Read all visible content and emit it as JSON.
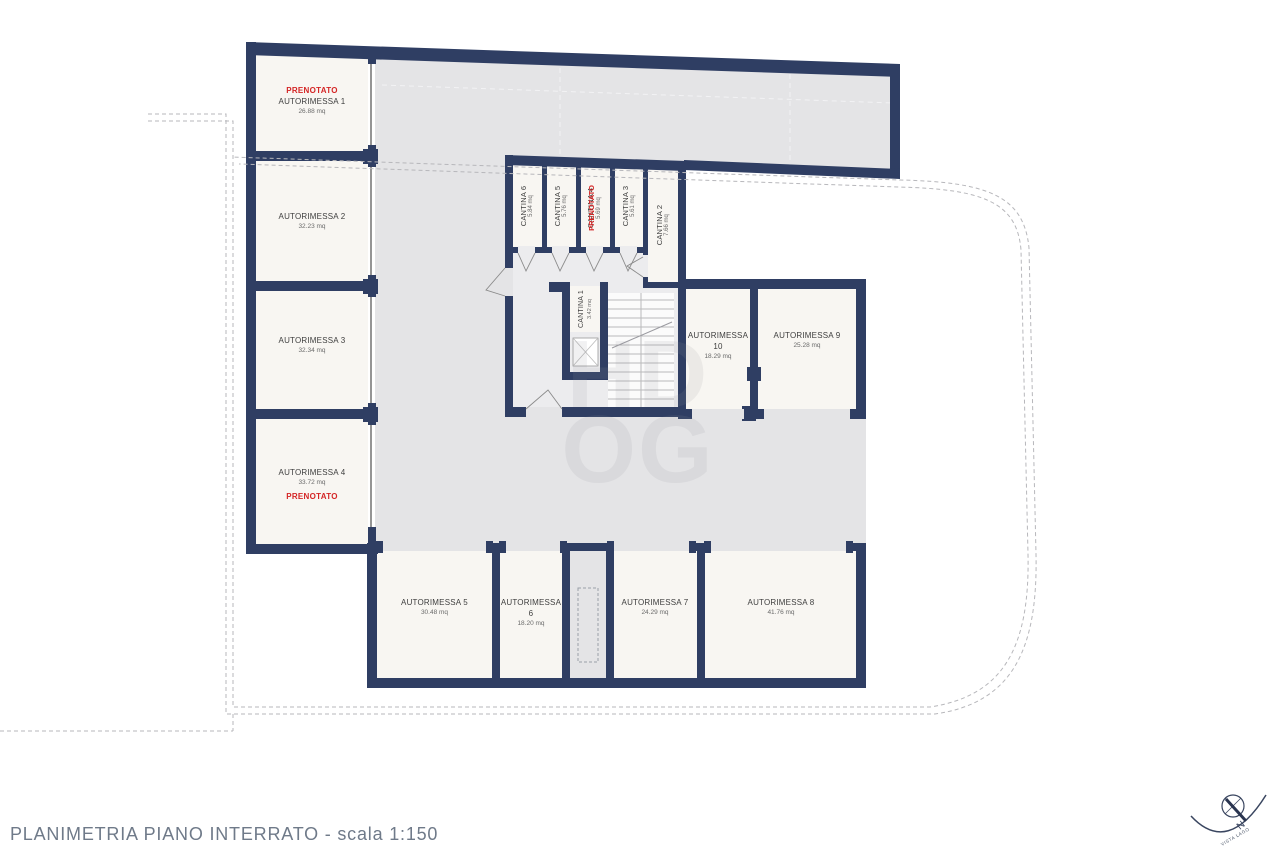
{
  "page_title": "PLANIMETRIA PIANO INTERRATO - scala 1:150",
  "reserved_label": "PRENOTATO",
  "watermark": {
    "line1": "HD",
    "line2": "OG"
  },
  "compass": {
    "north_label": "N",
    "view_label": "VISTA LAGO"
  },
  "rooms": {
    "garages": [
      {
        "name": "AUTORIMESSA 1",
        "area": "26.88 mq",
        "reserved": true
      },
      {
        "name": "AUTORIMESSA 2",
        "area": "32.23 mq",
        "reserved": false
      },
      {
        "name": "AUTORIMESSA 3",
        "area": "32.34 mq",
        "reserved": false
      },
      {
        "name": "AUTORIMESSA 4",
        "area": "33.72 mq",
        "reserved": true
      },
      {
        "name": "AUTORIMESSA 5",
        "area": "30.48 mq",
        "reserved": false
      },
      {
        "name": "AUTORIMESSA 6",
        "area": "18.20 mq",
        "reserved": false
      },
      {
        "name": "AUTORIMESSA 7",
        "area": "24.29 mq",
        "reserved": false
      },
      {
        "name": "AUTORIMESSA 8",
        "area": "41.76 mq",
        "reserved": false
      },
      {
        "name": "AUTORIMESSA 9",
        "area": "25.28 mq",
        "reserved": false
      },
      {
        "name": "AUTORIMESSA 10",
        "area": "18.29 mq",
        "reserved": false
      }
    ],
    "cellars": [
      {
        "name": "CANTINA 1",
        "area": "3.42 mq",
        "reserved": false
      },
      {
        "name": "CANTINA 2",
        "area": "7.66 mq",
        "reserved": false
      },
      {
        "name": "CANTINA 3",
        "area": "5.61 mq",
        "reserved": false
      },
      {
        "name": "CANTINA 4",
        "area": "5.69 mq",
        "reserved": true
      },
      {
        "name": "CANTINA 5",
        "area": "5.76 mq",
        "reserved": false
      },
      {
        "name": "CANTINA 6",
        "area": "5.84 mq",
        "reserved": false
      }
    ]
  },
  "colors": {
    "wall": "#2f3e63",
    "room_fill": "#f8f6f2",
    "driveway": "#e4e4e6",
    "stair_interior": "#ececee",
    "reserved_text": "#d42525",
    "title_text": "#6f7a89",
    "dashed_boundary": "#b7b7bb"
  }
}
